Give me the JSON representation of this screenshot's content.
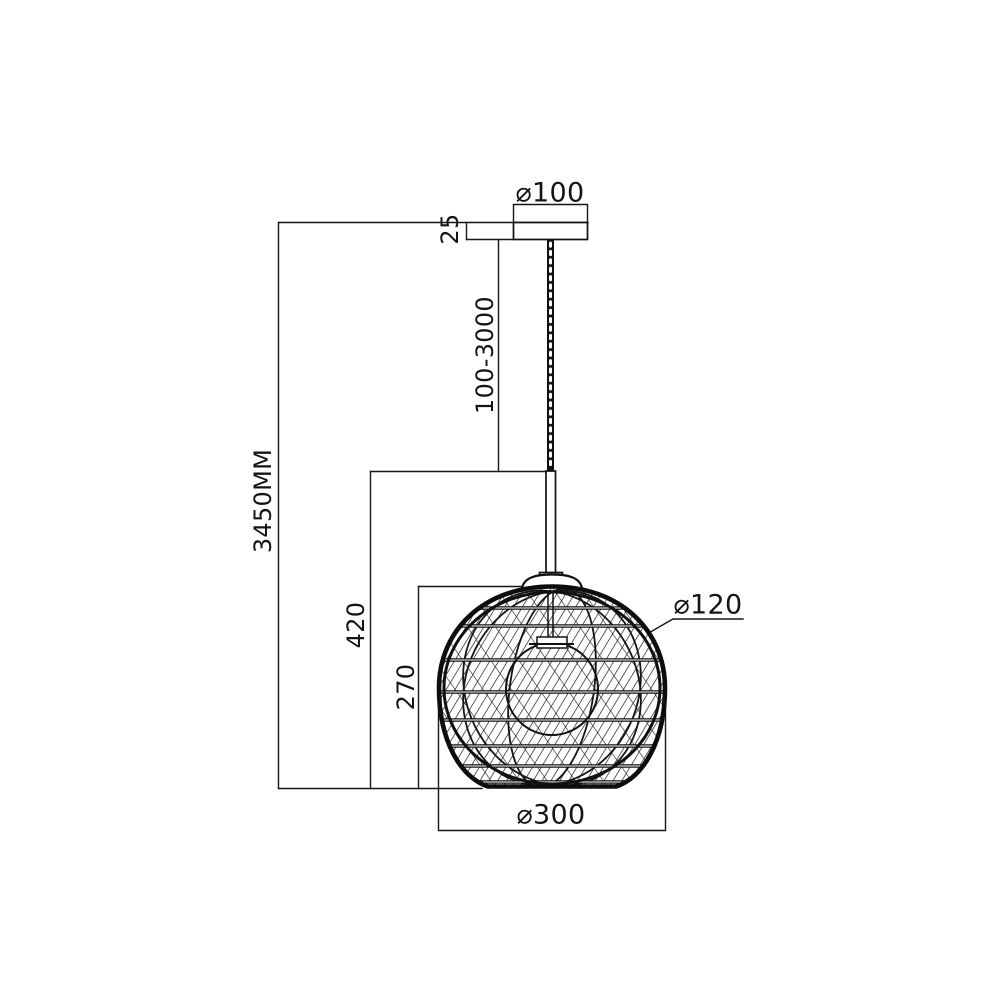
{
  "drawing": {
    "title": "pendant-lamp-dimension-diagram",
    "units": "mm",
    "background": "#ffffff",
    "line_color": "#161616",
    "dimensions": {
      "total_height": "3450MM",
      "canopy_diameter": "⌀100",
      "canopy_height": "25",
      "suspension_length_range": "100-3000",
      "body_height": "420",
      "shade_height": "270",
      "inner_ring_diameter": "⌀120",
      "shade_diameter": "⌀300"
    }
  }
}
